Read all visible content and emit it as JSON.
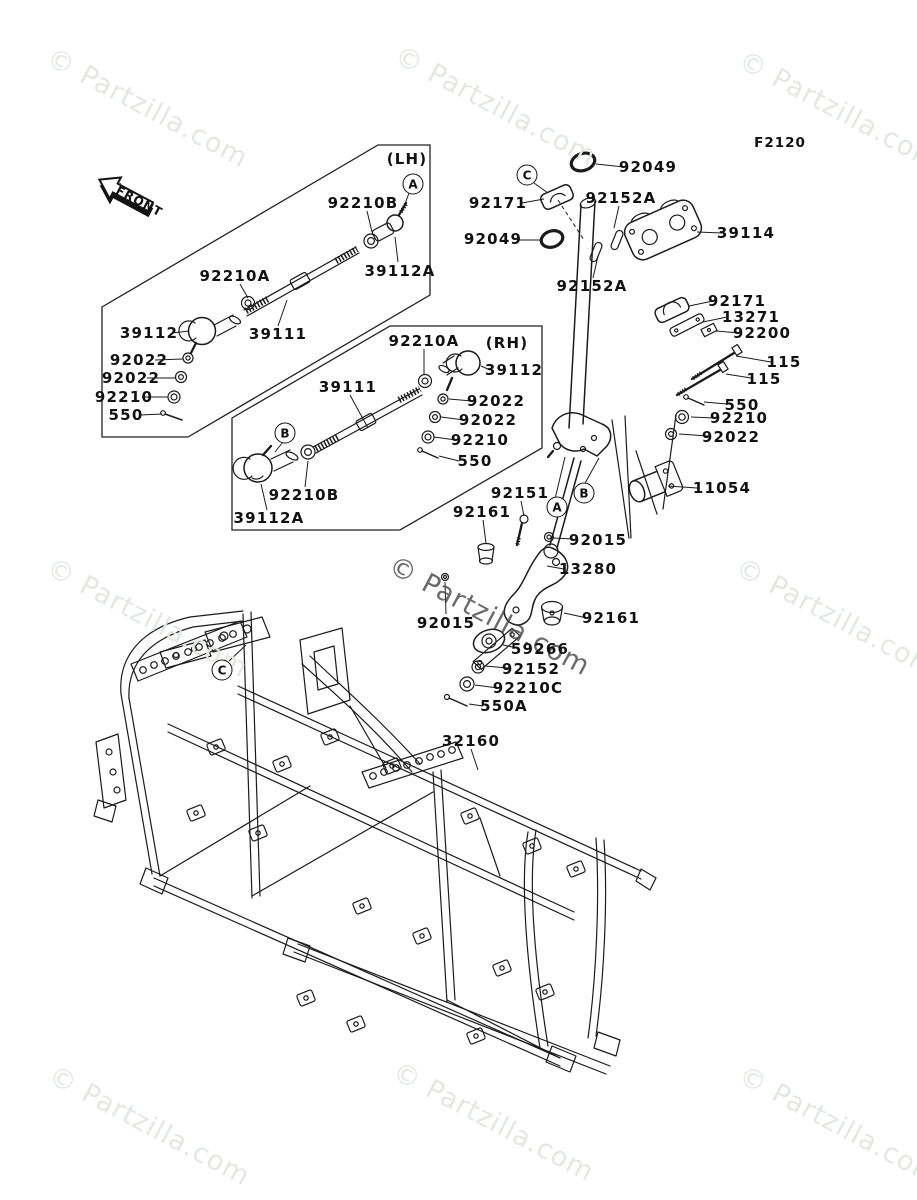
{
  "figure": {
    "code": "F2120",
    "front_label": "FRONT"
  },
  "watermark": {
    "text": "© Partzilla.com"
  },
  "groups": {
    "left": "(LH)",
    "right": "(RH)"
  },
  "refs": {
    "a": "A",
    "b": "B",
    "c": "C"
  },
  "colors": {
    "background": "#ffffff",
    "line": "#1b1b1b",
    "watermark_light": "#e3e8e3",
    "watermark_dark": "#4a4a4a"
  },
  "labels": [
    {
      "text": "92210B"
    },
    {
      "text": "92210A"
    },
    {
      "text": "39112A"
    },
    {
      "text": "39112"
    },
    {
      "text": "39111"
    },
    {
      "text": "92022"
    },
    {
      "text": "92022"
    },
    {
      "text": "92210"
    },
    {
      "text": "550"
    },
    {
      "text": "92210A"
    },
    {
      "text": "39112"
    },
    {
      "text": "39111"
    },
    {
      "text": "92022"
    },
    {
      "text": "92022"
    },
    {
      "text": "92210"
    },
    {
      "text": "550"
    },
    {
      "text": "92210B"
    },
    {
      "text": "39112A"
    },
    {
      "text": "92049"
    },
    {
      "text": "92171"
    },
    {
      "text": "92152A"
    },
    {
      "text": "39114"
    },
    {
      "text": "92049"
    },
    {
      "text": "92152A"
    },
    {
      "text": "92171"
    },
    {
      "text": "13271"
    },
    {
      "text": "92200"
    },
    {
      "text": "115"
    },
    {
      "text": "115"
    },
    {
      "text": "550"
    },
    {
      "text": "92210"
    },
    {
      "text": "92022"
    },
    {
      "text": "11054"
    },
    {
      "text": "92151"
    },
    {
      "text": "92161"
    },
    {
      "text": "92015"
    },
    {
      "text": "13280"
    },
    {
      "text": "92015"
    },
    {
      "text": "92161"
    },
    {
      "text": "59266"
    },
    {
      "text": "92152"
    },
    {
      "text": "92210C"
    },
    {
      "text": "550A"
    },
    {
      "text": "32160"
    }
  ]
}
